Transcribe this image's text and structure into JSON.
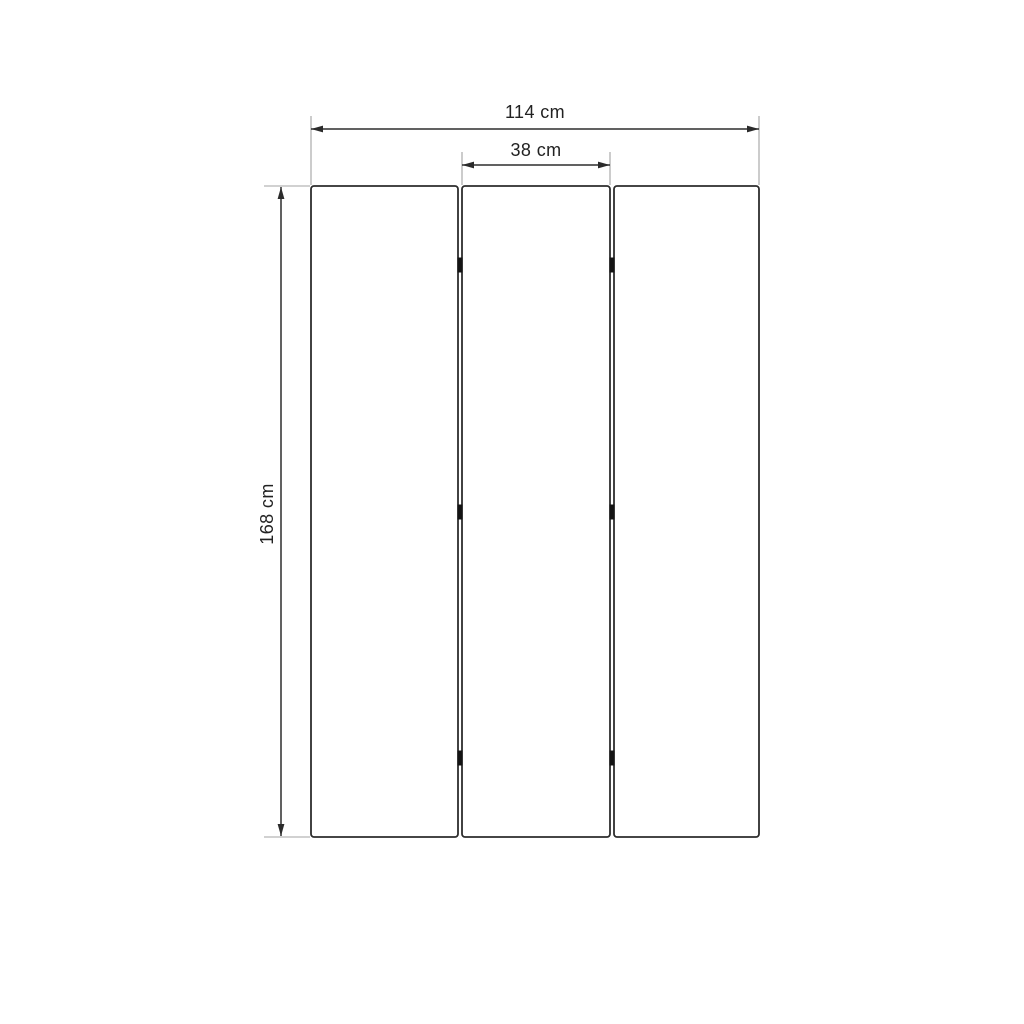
{
  "labels": {
    "total_width": "114 cm",
    "middle_panel_width": "38 cm",
    "height": "168 cm"
  },
  "measurements": {
    "total_width_cm": 114,
    "middle_panel_width_cm": 38,
    "height_cm": 168,
    "panel_count": 3,
    "hinge_marks_per_junction": 3
  },
  "colors": {
    "background": "#ffffff",
    "line": "#2d2d2d",
    "extension_line": "#a3a3a3",
    "text": "#222222",
    "hinge": "#141414"
  }
}
